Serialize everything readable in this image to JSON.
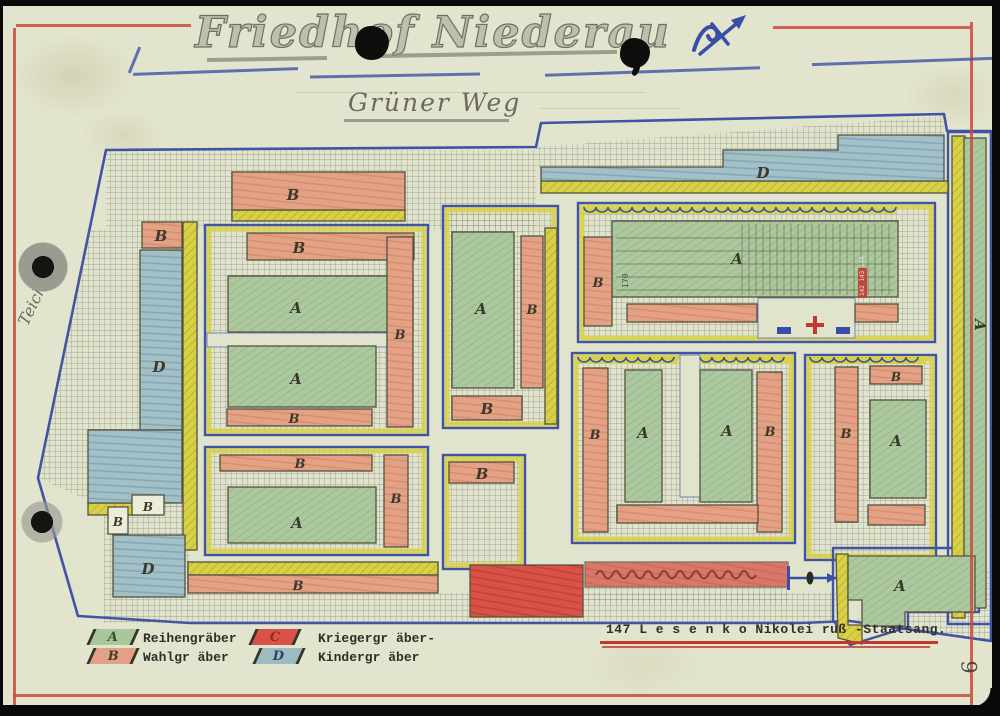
{
  "page": {
    "title": "Friedhof Niederau",
    "street_label": "Grüner Weg",
    "side_street_label": "Teichstr.",
    "page_number": "9",
    "typed_note": "147  L e s e n k o  Nikolei  ruß -Staatsang."
  },
  "legend": {
    "items": [
      {
        "letter": "A",
        "label": "Reihengräber",
        "color": "#a9c79b",
        "letter_color": "#3c4a33"
      },
      {
        "letter": "B",
        "label": "Wahlgr äber",
        "color": "#e2a184",
        "letter_color": "#4a3a30"
      },
      {
        "letter": "C",
        "label": "Kriegergr äber-",
        "color": "#d95248",
        "letter_color": "#8f2b24"
      },
      {
        "letter": "D",
        "label": "Kindergr äber",
        "color": "#9cbcc4",
        "letter_color": "#2d3f66"
      }
    ]
  },
  "colors": {
    "paper": "#e2e4cd",
    "pencil_blue": "#4053a6",
    "frame_red": "#c94a3c",
    "grave_green": "#a9c79b",
    "grave_salmon": "#e2a184",
    "grave_red": "#d95248",
    "grave_teal": "#9cbcc4",
    "path_yellow": "#d8d145"
  },
  "map": {
    "boundary": [
      [
        106,
        150
      ],
      [
        536,
        147
      ],
      [
        541,
        123
      ],
      [
        944,
        114
      ],
      [
        947,
        131
      ],
      [
        991,
        131
      ],
      [
        991,
        641
      ],
      [
        850,
        621
      ],
      [
        800,
        623
      ],
      [
        190,
        623
      ],
      [
        78,
        616
      ],
      [
        38,
        478
      ]
    ],
    "regions": [
      {
        "n": "hatch-top-band",
        "f": "hatch",
        "s": "rect",
        "x": 106,
        "y": 150,
        "w": 430,
        "h": 80
      },
      {
        "n": "hatch-topright-band",
        "f": "hatch",
        "s": "poly",
        "pts": [
          [
            536,
            147
          ],
          [
            944,
            116
          ],
          [
            944,
            136
          ],
          [
            838,
            136
          ],
          [
            838,
            151
          ],
          [
            723,
            151
          ],
          [
            723,
            168
          ],
          [
            536,
            168
          ]
        ]
      },
      {
        "n": "hatch-left-wedge",
        "f": "hatch",
        "s": "poly",
        "pts": [
          [
            88,
            230
          ],
          [
            183,
            230
          ],
          [
            183,
            507
          ],
          [
            104,
            507
          ],
          [
            38,
            478
          ]
        ]
      },
      {
        "n": "hatch-bottom-left",
        "f": "hatch",
        "s": "rect",
        "x": 104,
        "y": 505,
        "w": 86,
        "h": 118
      },
      {
        "n": "hatch-bottom-band",
        "f": "hatch",
        "s": "rect",
        "x": 188,
        "y": 593,
        "w": 648,
        "h": 30
      },
      {
        "n": "hatch-under-note-strip",
        "f": "hatch",
        "s": "rect",
        "x": 583,
        "y": 586,
        "w": 205,
        "h": 18
      },
      {
        "n": "hatch-southeast-triangle",
        "f": "hatch",
        "s": "poly",
        "pts": [
          [
            850,
            621
          ],
          [
            990,
            568
          ],
          [
            990,
            640
          ]
        ]
      },
      {
        "n": "court-1",
        "f": "court",
        "s": "rect",
        "x": 205,
        "y": 225,
        "w": 223,
        "h": 210
      },
      {
        "n": "court-2",
        "f": "court",
        "s": "rect",
        "x": 205,
        "y": 447,
        "w": 223,
        "h": 108
      },
      {
        "n": "court-3",
        "f": "court",
        "s": "rect",
        "x": 443,
        "y": 206,
        "w": 115,
        "h": 222
      },
      {
        "n": "court-4",
        "f": "court",
        "s": "rect",
        "x": 443,
        "y": 455,
        "w": 82,
        "h": 114
      },
      {
        "n": "court-5",
        "f": "court",
        "s": "rect",
        "x": 578,
        "y": 203,
        "w": 357,
        "h": 139
      },
      {
        "n": "court-6",
        "f": "court",
        "s": "rect",
        "x": 572,
        "y": 353,
        "w": 223,
        "h": 190
      },
      {
        "n": "court-7",
        "f": "court",
        "s": "rect",
        "x": 805,
        "y": 355,
        "w": 131,
        "h": 205
      },
      {
        "n": "court-8-outline",
        "f": "outline",
        "s": "rect",
        "x": 948,
        "y": 132,
        "w": 44,
        "h": 492
      },
      {
        "n": "court-9-outline",
        "f": "outline",
        "s": "poly",
        "pts": [
          [
            833,
            548
          ],
          [
            979,
            548
          ],
          [
            979,
            612
          ],
          [
            908,
            612
          ],
          [
            908,
            627
          ],
          [
            850,
            645
          ],
          [
            833,
            620
          ]
        ]
      },
      {
        "n": "lane-court1",
        "f": "lane",
        "s": "rect",
        "x": 207,
        "y": 333,
        "w": 180,
        "h": 14
      },
      {
        "n": "lane-court6-notch",
        "f": "lane",
        "s": "rect",
        "x": 680,
        "y": 355,
        "w": 20,
        "h": 142
      },
      {
        "n": "lane-court5-entrance",
        "f": "lane",
        "s": "rect",
        "x": 758,
        "y": 298,
        "w": 97,
        "h": 40
      },
      {
        "n": "yellow-under-top-b",
        "f": "yellow",
        "s": "rect",
        "x": 232,
        "y": 210,
        "w": 173,
        "h": 11
      },
      {
        "n": "yellow-vertical-band",
        "f": "yellow",
        "s": "rect",
        "x": 183,
        "y": 222,
        "w": 14,
        "h": 328
      },
      {
        "n": "yellow-left-small",
        "f": "yellow",
        "s": "rect",
        "x": 88,
        "y": 503,
        "w": 70,
        "h": 12
      },
      {
        "n": "yellow-under-d-strip",
        "f": "yellow",
        "s": "rect",
        "x": 541,
        "y": 181,
        "w": 407,
        "h": 12
      },
      {
        "n": "yellow-court3-edge",
        "f": "yellow",
        "s": "rect",
        "x": 545,
        "y": 228,
        "w": 12,
        "h": 196
      },
      {
        "n": "yellow-above-bottom-b",
        "f": "yellow",
        "s": "rect",
        "x": 188,
        "y": 562,
        "w": 250,
        "h": 13
      },
      {
        "n": "yellow-court8-band",
        "f": "yellow",
        "s": "rect",
        "x": 952,
        "y": 136,
        "w": 13,
        "h": 482
      },
      {
        "n": "yellow-court9-edge",
        "f": "yellow",
        "s": "poly",
        "pts": [
          [
            836,
            554
          ],
          [
            848,
            554
          ],
          [
            848,
            625
          ],
          [
            862,
            625
          ],
          [
            862,
            644
          ],
          [
            838,
            638
          ]
        ]
      },
      {
        "n": "strip-d-north",
        "f": "teal",
        "s": "poly",
        "pts": [
          [
            541,
            167
          ],
          [
            723,
            167
          ],
          [
            723,
            150
          ],
          [
            838,
            150
          ],
          [
            838,
            135
          ],
          [
            944,
            135
          ],
          [
            944,
            181
          ],
          [
            541,
            181
          ]
        ],
        "l": "D",
        "lx": 763,
        "ly": 178
      },
      {
        "n": "block-d-west",
        "f": "teal",
        "s": "rect",
        "x": 140,
        "y": 250,
        "w": 42,
        "h": 180,
        "l": "D",
        "lx": 159,
        "ly": 372
      },
      {
        "n": "block-d-west-lower",
        "f": "teal",
        "s": "rect",
        "x": 88,
        "y": 430,
        "w": 94,
        "h": 73
      },
      {
        "n": "block-d-southwest",
        "f": "teal",
        "s": "rect",
        "x": 113,
        "y": 535,
        "w": 72,
        "h": 62,
        "l": "D",
        "lx": 148,
        "ly": 574
      },
      {
        "n": "block-a-c1-upper",
        "f": "green",
        "s": "rect",
        "x": 228,
        "y": 276,
        "w": 185,
        "h": 56,
        "l": "A",
        "lx": 296,
        "ly": 313
      },
      {
        "n": "block-a-c1-lower",
        "f": "green",
        "s": "rect",
        "x": 228,
        "y": 346,
        "w": 148,
        "h": 61,
        "l": "A",
        "lx": 296,
        "ly": 384
      },
      {
        "n": "block-a-c2",
        "f": "green",
        "s": "rect",
        "x": 228,
        "y": 487,
        "w": 148,
        "h": 56,
        "l": "A",
        "lx": 297,
        "ly": 528
      },
      {
        "n": "block-a-c3",
        "f": "green",
        "s": "rect",
        "x": 452,
        "y": 232,
        "w": 62,
        "h": 156,
        "l": "A",
        "lx": 481,
        "ly": 314
      },
      {
        "n": "block-a-c5",
        "f": "green",
        "s": "rect",
        "x": 612,
        "y": 221,
        "w": 286,
        "h": 76,
        "l": "A",
        "lx": 737,
        "ly": 264
      },
      {
        "n": "block-a-c6-left",
        "f": "green",
        "s": "rect",
        "x": 625,
        "y": 370,
        "w": 37,
        "h": 132,
        "l": "A",
        "lx": 643,
        "ly": 438
      },
      {
        "n": "block-a-c6-right",
        "f": "green",
        "s": "rect",
        "x": 700,
        "y": 370,
        "w": 52,
        "h": 132,
        "l": "A",
        "lx": 727,
        "ly": 436
      },
      {
        "n": "block-a-c7",
        "f": "green",
        "s": "rect",
        "x": 870,
        "y": 400,
        "w": 56,
        "h": 98,
        "l": "A",
        "lx": 896,
        "ly": 446
      },
      {
        "n": "block-a-east-strip",
        "f": "green",
        "s": "rect",
        "x": 964,
        "y": 138,
        "w": 22,
        "h": 470,
        "l": "A",
        "lx": 975,
        "ly": 325,
        "rot": 90
      },
      {
        "n": "block-a-southeast",
        "f": "green",
        "s": "poly",
        "pts": [
          [
            848,
            556
          ],
          [
            975,
            556
          ],
          [
            975,
            612
          ],
          [
            905,
            612
          ],
          [
            905,
            626
          ],
          [
            862,
            626
          ],
          [
            862,
            600
          ],
          [
            848,
            600
          ]
        ],
        "l": "A",
        "lx": 900,
        "ly": 591
      },
      {
        "n": "block-b-top",
        "f": "salmon",
        "s": "rect",
        "x": 232,
        "y": 172,
        "w": 173,
        "h": 38,
        "l": "B",
        "lx": 293,
        "ly": 200
      },
      {
        "n": "block-b-west-small",
        "f": "salmon",
        "s": "rect",
        "x": 142,
        "y": 222,
        "w": 40,
        "h": 26,
        "l": "B",
        "lx": 161,
        "ly": 241
      },
      {
        "n": "block-b-c1-top",
        "f": "salmon",
        "s": "rect",
        "x": 247,
        "y": 233,
        "w": 167,
        "h": 27,
        "l": "B",
        "lx": 299,
        "ly": 253
      },
      {
        "n": "block-b-c1-bottom",
        "f": "salmon",
        "s": "rect",
        "x": 227,
        "y": 409,
        "w": 145,
        "h": 17,
        "l": "B",
        "lx": 294,
        "ly": 423,
        "ls": 13
      },
      {
        "n": "block-b-c1-east",
        "f": "salmon",
        "s": "rect",
        "x": 387,
        "y": 237,
        "w": 26,
        "h": 190,
        "l": "B",
        "lx": 400,
        "ly": 339,
        "ls": 13
      },
      {
        "n": "block-b-c2-top",
        "f": "salmon",
        "s": "rect",
        "x": 220,
        "y": 455,
        "w": 152,
        "h": 16,
        "l": "B",
        "lx": 300,
        "ly": 468,
        "ls": 13
      },
      {
        "n": "block-b-c2-east",
        "f": "salmon",
        "s": "rect",
        "x": 384,
        "y": 455,
        "w": 24,
        "h": 92,
        "l": "B",
        "lx": 396,
        "ly": 503,
        "ls": 13
      },
      {
        "n": "block-b-c3-east",
        "f": "salmon",
        "s": "rect",
        "x": 521,
        "y": 236,
        "w": 22,
        "h": 152,
        "l": "B",
        "lx": 532,
        "ly": 314,
        "ls": 13
      },
      {
        "n": "block-b-c3-bottom",
        "f": "salmon",
        "s": "rect",
        "x": 452,
        "y": 396,
        "w": 70,
        "h": 24,
        "l": "B",
        "lx": 487,
        "ly": 414
      },
      {
        "n": "block-b-c4",
        "f": "salmon",
        "s": "rect",
        "x": 449,
        "y": 462,
        "w": 65,
        "h": 21,
        "l": "B",
        "lx": 482,
        "ly": 479
      },
      {
        "n": "block-b-c5-west",
        "f": "salmon",
        "s": "rect",
        "x": 584,
        "y": 237,
        "w": 28,
        "h": 89,
        "l": "B",
        "lx": 598,
        "ly": 287,
        "ls": 13
      },
      {
        "n": "strip-b-c5-south1",
        "f": "salmon",
        "s": "rect",
        "x": 627,
        "y": 304,
        "w": 130,
        "h": 18
      },
      {
        "n": "strip-b-c5-south2",
        "f": "salmon",
        "s": "rect",
        "x": 855,
        "y": 304,
        "w": 43,
        "h": 18
      },
      {
        "n": "block-b-c6-west",
        "f": "salmon",
        "s": "rect",
        "x": 583,
        "y": 368,
        "w": 25,
        "h": 164,
        "l": "B",
        "lx": 595,
        "ly": 439,
        "ls": 13
      },
      {
        "n": "block-b-c6-east",
        "f": "salmon",
        "s": "rect",
        "x": 757,
        "y": 372,
        "w": 25,
        "h": 160,
        "l": "B",
        "lx": 770,
        "ly": 436,
        "ls": 13
      },
      {
        "n": "strip-b-c6-south",
        "f": "salmon",
        "s": "rect",
        "x": 617,
        "y": 505,
        "w": 141,
        "h": 18
      },
      {
        "n": "block-b-c7-west",
        "f": "salmon",
        "s": "rect",
        "x": 835,
        "y": 367,
        "w": 23,
        "h": 155,
        "l": "B",
        "lx": 846,
        "ly": 438,
        "ls": 13
      },
      {
        "n": "block-b-c7-top",
        "f": "salmon",
        "s": "rect",
        "x": 870,
        "y": 366,
        "w": 52,
        "h": 18,
        "l": "B",
        "lx": 896,
        "ly": 381,
        "ls": 12
      },
      {
        "n": "strip-b-c7-south",
        "f": "salmon",
        "s": "rect",
        "x": 868,
        "y": 505,
        "w": 57,
        "h": 20
      },
      {
        "n": "strip-b-bottom",
        "f": "salmon",
        "s": "rect",
        "x": 188,
        "y": 575,
        "w": 250,
        "h": 18,
        "l": "B",
        "lx": 298,
        "ly": 590,
        "ls": 13
      },
      {
        "n": "strip-note-red",
        "f": "red",
        "s": "rect",
        "x": 585,
        "y": 562,
        "w": 203,
        "h": 25,
        "op": 0.75
      },
      {
        "n": "block-c-war-graves",
        "f": "red",
        "s": "rect",
        "x": 470,
        "y": 565,
        "w": 113,
        "h": 52
      },
      {
        "n": "box-b-small-1",
        "f": "white",
        "s": "rect",
        "x": 132,
        "y": 495,
        "w": 32,
        "h": 20,
        "l": "B",
        "lx": 148,
        "ly": 511,
        "ls": 12
      },
      {
        "n": "box-b-small-2",
        "f": "white",
        "s": "rect",
        "x": 108,
        "y": 507,
        "w": 20,
        "h": 27,
        "l": "B",
        "lx": 118,
        "ly": 526,
        "ls": 12
      }
    ],
    "decorations": [
      {
        "k": "scallop",
        "x": 584,
        "y": 206,
        "w": 312
      },
      {
        "k": "scallop",
        "x": 578,
        "y": 356,
        "w": 100
      },
      {
        "k": "scallop",
        "x": 700,
        "y": 356,
        "w": 93
      },
      {
        "k": "scallop",
        "x": 810,
        "y": 356,
        "w": 116
      },
      {
        "k": "grid",
        "x": 742,
        "y": 224,
        "w": 153,
        "h": 71,
        "step": 7
      },
      {
        "k": "hlines",
        "x": 616,
        "y": 238,
        "w": 278,
        "step": 13,
        "n": 5
      },
      {
        "k": "redmark",
        "x": 858,
        "y": 268,
        "w": 9,
        "h": 30
      },
      {
        "k": "smalltext",
        "t": "170",
        "x": 628,
        "y": 288,
        "rot": -90,
        "size": 8,
        "c": "#4a4a40"
      },
      {
        "k": "smalltext",
        "t": "142 143 144",
        "x": 864,
        "y": 296,
        "rot": -90,
        "size": 6,
        "c": "#f2dede"
      },
      {
        "k": "cross",
        "x": 806,
        "y": 316
      },
      {
        "k": "bluemark",
        "x": 777,
        "y": 327,
        "w": 14,
        "h": 7
      },
      {
        "k": "bluemark",
        "x": 836,
        "y": 327,
        "w": 14,
        "h": 7
      },
      {
        "k": "tick",
        "x": 787,
        "y": 566,
        "h": 24
      },
      {
        "k": "arrow",
        "x1": 790,
        "y1": 578,
        "x2": 836,
        "y2": 578
      },
      {
        "k": "lens",
        "x": 810,
        "y": 578
      },
      {
        "k": "scribble",
        "x": 596,
        "y": 575,
        "w": 170
      }
    ]
  }
}
